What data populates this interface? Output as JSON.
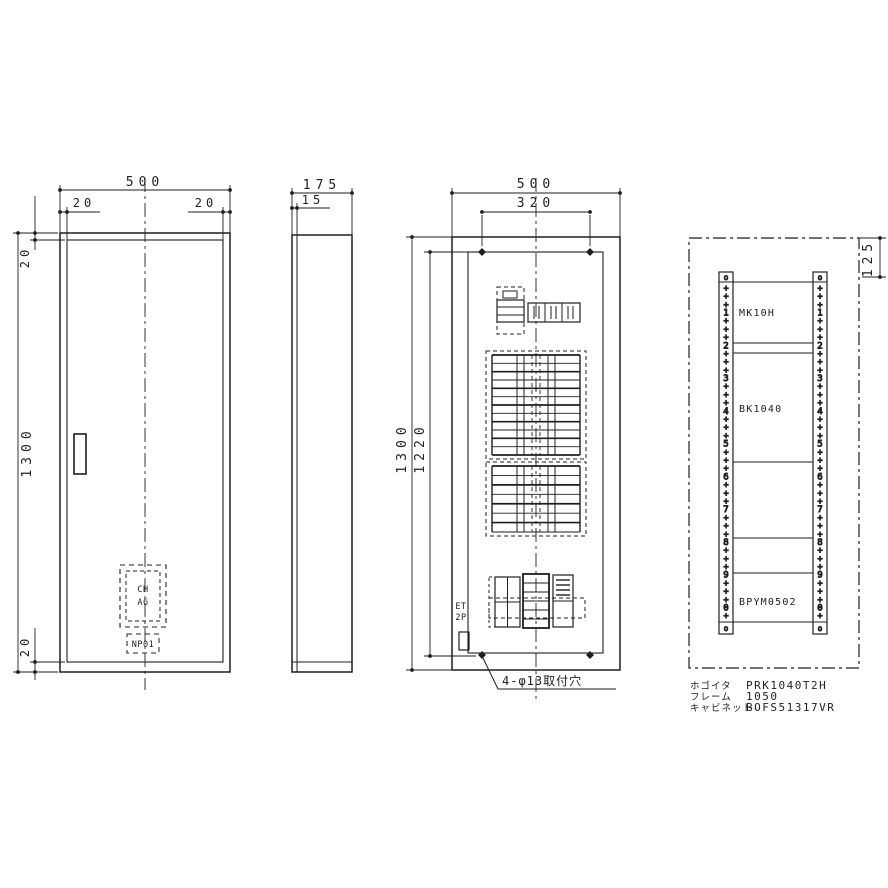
{
  "front_view": {
    "dim_width": "500",
    "dim_margin_left": "20",
    "dim_margin_right": "20",
    "dim_margin_top": "20",
    "dim_height": "1300",
    "dim_margin_bottom": "20",
    "breaker_label_line1": "CH",
    "breaker_label_line2": "A6",
    "nameplate_label": "NP01"
  },
  "side_view": {
    "dim_depth": "175",
    "dim_door_thickness": "15"
  },
  "internal_view": {
    "dim_width": "500",
    "dim_hole_pitch": "320",
    "dim_height": "1300",
    "dim_hole_height": "1220",
    "elb_label_line1": "ET",
    "elb_label_line2": "2P",
    "mounting_holes_note": "4-φ13取付穴"
  },
  "schematic_view": {
    "dim_top_offset": "125",
    "rail_terminal_mark": "o",
    "rail_sequence": [
      "+",
      "+",
      "+",
      "1",
      "+",
      "+",
      "+",
      "2",
      "+",
      "+",
      "+",
      "3",
      "+",
      "+",
      "+",
      "4",
      "+",
      "+",
      "+",
      "5",
      "+",
      "+",
      "+",
      "6",
      "+",
      "+",
      "+",
      "7",
      "+",
      "+",
      "+",
      "8",
      "+",
      "+",
      "+",
      "9",
      "+",
      "+",
      "+",
      "0",
      "+"
    ],
    "sections": [
      {
        "label": "MK10H"
      },
      {
        "label": "BK1040"
      },
      {
        "label": ""
      },
      {
        "label": ""
      },
      {
        "label": "BPYM0502"
      }
    ],
    "notes": [
      {
        "label": "ホゴイタ",
        "value": "PRK1040T2H"
      },
      {
        "label": "フレーム",
        "value": "1050"
      },
      {
        "label": "キャビネット",
        "value": "BOFS51317VR"
      }
    ]
  }
}
